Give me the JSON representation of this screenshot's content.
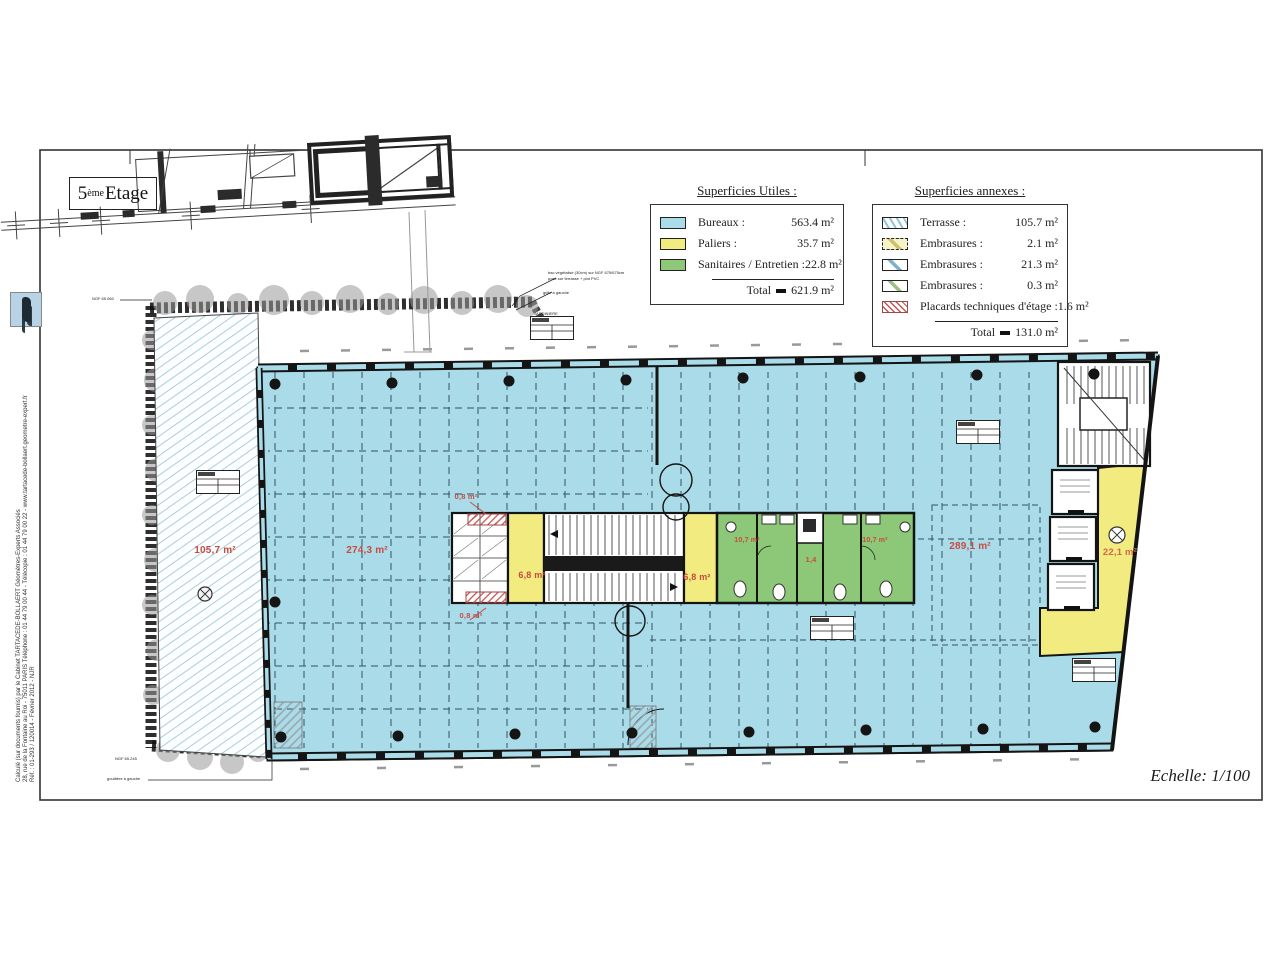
{
  "sheet": {
    "title_num": "5",
    "title_sup": "ème",
    "title_rest": " Etage",
    "scale_label": "Echelle: 1/100"
  },
  "credits": {
    "line1": "Calculé (sur documents fournis) par le Cabinet TARTACEDE-BOLLAERT Géomètres-Experts Associés",
    "line2": "28, rue de la Fontaine au Roi - 75011 PARIS Téléphone : 01 44 79 00 44 - Télécopie : 01 44 79 00 22 - www.tartacede-bollaert.geometre-expert.fr",
    "line3": "Réf. : 01-293 / 120014 - Février 2012 - NJR"
  },
  "legend_utiles": {
    "title": "Superficies Utiles :",
    "rows": [
      {
        "label": "Bureaux :",
        "value": "563.4 m²"
      },
      {
        "label": "Paliers :",
        "value": "35.7 m²"
      },
      {
        "label": "Sanitaires / Entretien :",
        "value": "22.8 m²"
      }
    ],
    "total_label": "Total",
    "total_value": "621.9 m²"
  },
  "legend_annexes": {
    "title": "Superficies annexes :",
    "rows": [
      {
        "label": "Terrasse :",
        "value": "105.7 m²"
      },
      {
        "label": "Embrasures :",
        "value": "2.1 m²"
      },
      {
        "label": "Embrasures :",
        "value": "21.3 m²"
      },
      {
        "label": "Embrasures :",
        "value": "0.3 m²"
      },
      {
        "label": "Placards techniques d'étage :",
        "value": "1.6 m²"
      }
    ],
    "total_label": "Total",
    "total_value": "131.0 m²"
  },
  "plan_labels": {
    "terrasse": "105,7 m²",
    "bureaux_ouest": "274,3 m²",
    "bureaux_est": "289,1 m²",
    "palier_ouest": "6,8 m²",
    "palier_centre": "6,8 m²",
    "palier_est": "22,1 m²",
    "sanitaires_ouest": "10,7 m²",
    "sanitaires_est": "10,7 m²",
    "entretien": "1,4",
    "placard_haut": "0,8 m²",
    "placard_bas": "0,8 m²"
  },
  "annotations": {
    "jardiniere": "JARDINIERE",
    "bac_line1": "bac végétalisé (30cm) sur NGF 675/675cm",
    "bac_line2": "posé sur terrasse + plot PVC",
    "grille": "grille à gauche",
    "ngf_haut": "NGF 65.060",
    "ngf_bas": "NGF 65.245",
    "gouttiere": "gouttière à gauche"
  },
  "colors": {
    "bureaux": "#a9dbe9",
    "paliers": "#f1eb80",
    "sanitaires": "#8cc878",
    "terrasse_hatch": "#8fc6da",
    "label_red": "#c84b41",
    "wall": "#141414"
  }
}
